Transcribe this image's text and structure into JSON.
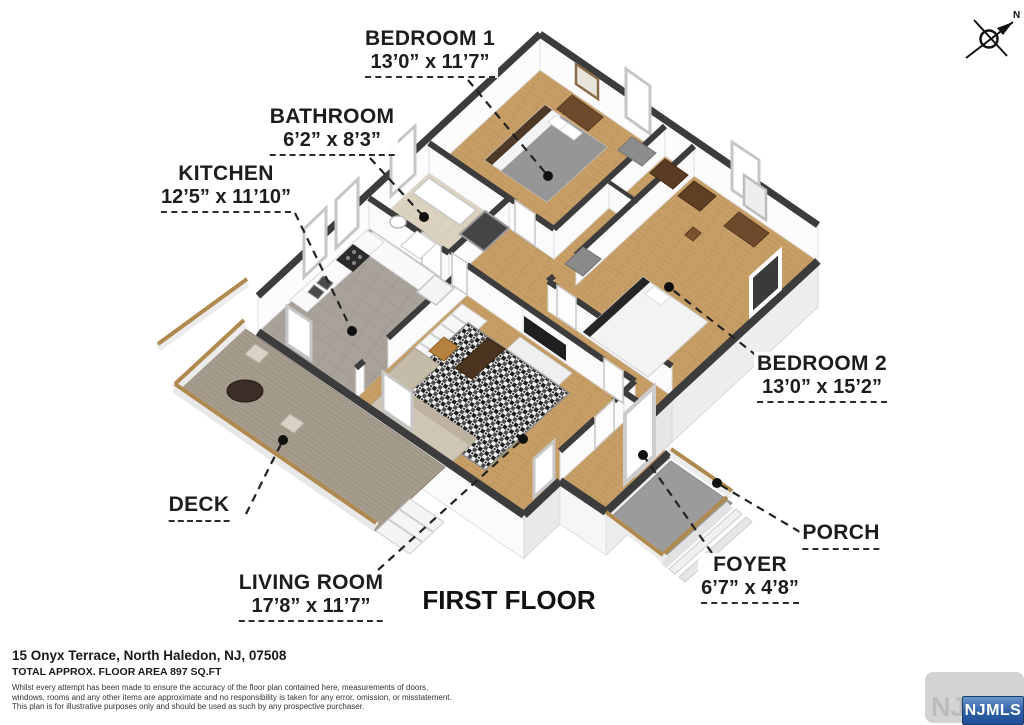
{
  "title": "FIRST FLOOR",
  "compass": {
    "north_label": "N"
  },
  "rooms": [
    {
      "id": "bedroom1",
      "name": "BEDROOM 1",
      "dims": "13’0” x 11’7”"
    },
    {
      "id": "bathroom",
      "name": "BATHROOM",
      "dims": "6’2” x 8’3”"
    },
    {
      "id": "kitchen",
      "name": "KITCHEN",
      "dims": "12’5” x 11’10”"
    },
    {
      "id": "bedroom2",
      "name": "BEDROOM 2",
      "dims": "13’0” x 15’2”"
    },
    {
      "id": "deck",
      "name": "DECK",
      "dims": ""
    },
    {
      "id": "living",
      "name": "LIVING ROOM",
      "dims": "17’8” x 11’7”"
    },
    {
      "id": "foyer",
      "name": "FOYER",
      "dims": "6’7” x 4’8”"
    },
    {
      "id": "porch",
      "name": "PORCH",
      "dims": ""
    }
  ],
  "footer": {
    "address": "15 Onyx Terrace, North Haledon, NJ, 07508",
    "area": "TOTAL APPROX. FLOOR AREA 897 SQ.FT",
    "disclaimer_line1": "Whilst every attempt has been made to ensure the accuracy of the floor plan contained here, measurements of doors,",
    "disclaimer_line2": "windows, rooms and any other items are approximate and no responsibility is taken for any error, omission, or misstatement.",
    "disclaimer_line3": "This plan is for illustrative purposes only and should be used as such by any prospective purchaser."
  },
  "watermark": {
    "text": "NJMLS",
    "badge_text": "NJMLS"
  },
  "colors": {
    "wall_cap": "#3c3c3c",
    "wood_floor": "#c79e66",
    "kitchen_tile": "#a8a29a",
    "bathroom_tile": "#dcd2c0",
    "deck_boards": "#a69c8d",
    "porch_floor": "#9b9b9b",
    "rail_wood": "#b0894e",
    "badge_blue": "#2c5fa5"
  }
}
